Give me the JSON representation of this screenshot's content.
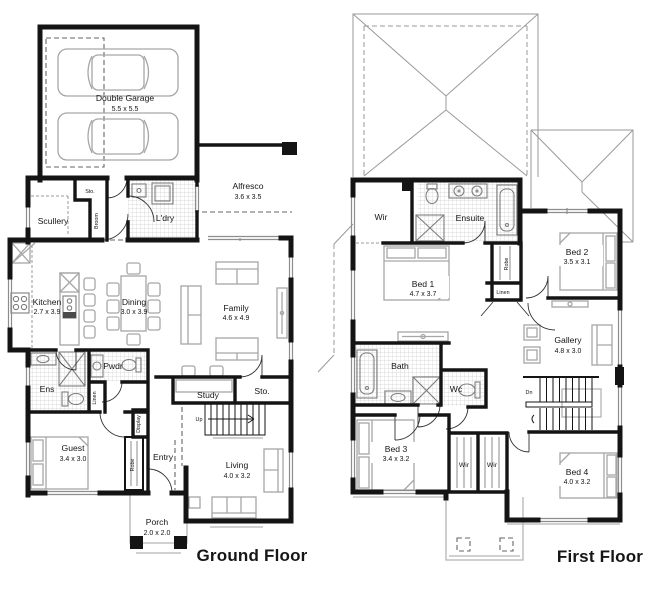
{
  "colors": {
    "background": "#ffffff",
    "wall": "#141414",
    "furniture": "#a6a6a6",
    "window": "#8d8d8d",
    "roof": "#9a9a9a",
    "text": "#161616"
  },
  "ground_floor": {
    "title": "Ground Floor",
    "rooms": {
      "garage": {
        "name": "Double Garage",
        "dims": "5.5 x 5.5"
      },
      "alfresco": {
        "name": "Alfresco",
        "dims": "3.6 x 3.5"
      },
      "sto_top": {
        "name": "Sto."
      },
      "scullery": {
        "name": "Scullery"
      },
      "broom": {
        "name": "Broom"
      },
      "laundry": {
        "name": "L'dry"
      },
      "kitchen": {
        "name": "Kitchen",
        "dims": "2.7 x 3.9"
      },
      "dining": {
        "name": "Dining",
        "dims": "3.0 x 3.9"
      },
      "family": {
        "name": "Family",
        "dims": "4.6 x 4.9"
      },
      "ens": {
        "name": "Ens"
      },
      "pwdr": {
        "name": "Pwdr"
      },
      "linen": {
        "name": "Linen"
      },
      "study": {
        "name": "Study"
      },
      "sto": {
        "name": "Sto."
      },
      "stairs": {
        "name": "Up"
      },
      "display": {
        "name": "Display"
      },
      "guest": {
        "name": "Guest",
        "dims": "3.4 x 3.0"
      },
      "robe": {
        "name": "Robe"
      },
      "entry": {
        "name": "Entry"
      },
      "living": {
        "name": "Living",
        "dims": "4.0 x 3.2"
      },
      "porch": {
        "name": "Porch",
        "dims": "2.0 x 2.0"
      }
    }
  },
  "first_floor": {
    "title": "First Floor",
    "rooms": {
      "wir_master": {
        "name": "Wir"
      },
      "ensuite": {
        "name": "Ensuite"
      },
      "bed1": {
        "name": "Bed 1",
        "dims": "4.7 x 3.7"
      },
      "bed2": {
        "name": "Bed 2",
        "dims": "3.5 x 3.1"
      },
      "robe": {
        "name": "Robe"
      },
      "linen": {
        "name": "Linen"
      },
      "gallery": {
        "name": "Gallery",
        "dims": "4.8 x 3.0"
      },
      "bath": {
        "name": "Bath"
      },
      "wc": {
        "name": "Wc"
      },
      "stairs": {
        "name": "Dn"
      },
      "bed3": {
        "name": "Bed 3",
        "dims": "3.4 x 3.2"
      },
      "wir_a": {
        "name": "Wir"
      },
      "wir_b": {
        "name": "Wir"
      },
      "bed4": {
        "name": "Bed 4",
        "dims": "4.0 x 3.2"
      }
    }
  }
}
